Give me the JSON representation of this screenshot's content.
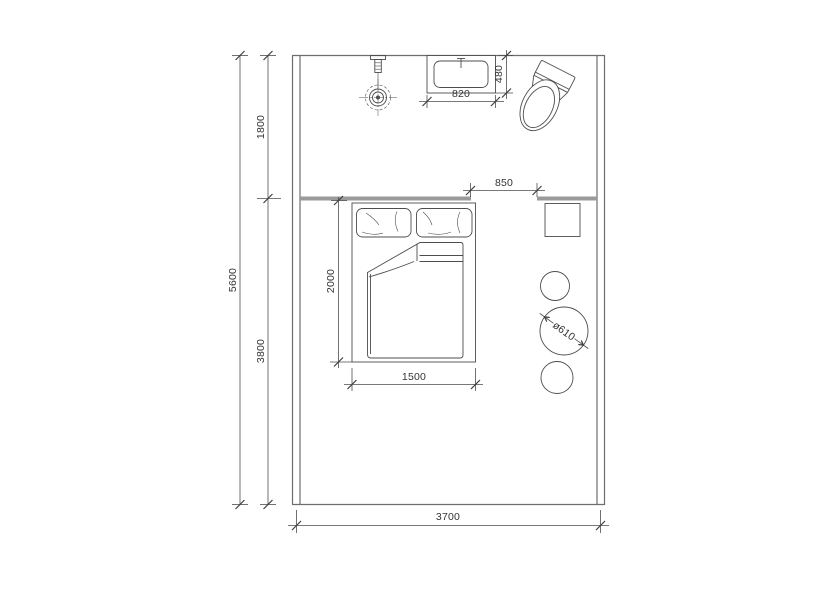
{
  "meta": {
    "title": "Bedroom and bathroom floor plan",
    "drawing_type": "floor-plan"
  },
  "dimensions": {
    "total_depth": "5600",
    "bath_zone_depth": "1800",
    "sleep_zone_depth": "3800",
    "room_width": "3700",
    "opening_width": "850",
    "basin_width": "820",
    "basin_depth": "480",
    "bed_length": "2000",
    "bed_width": "1500",
    "table_diameter": "ø610"
  },
  "fixtures": {
    "shower": "shower-head-symbol",
    "basin": "wash-basin-symbol",
    "toilet": "toilet-symbol",
    "bed": "double-bed-symbol",
    "nightstand": "side-table-symbol",
    "stools": "round-stool-symbols"
  },
  "colors": {
    "background": "#ffffff",
    "line": "#4d4d4d",
    "wall": "#6e6e6e",
    "partition": "#9a9a9a",
    "text": "#333333"
  }
}
